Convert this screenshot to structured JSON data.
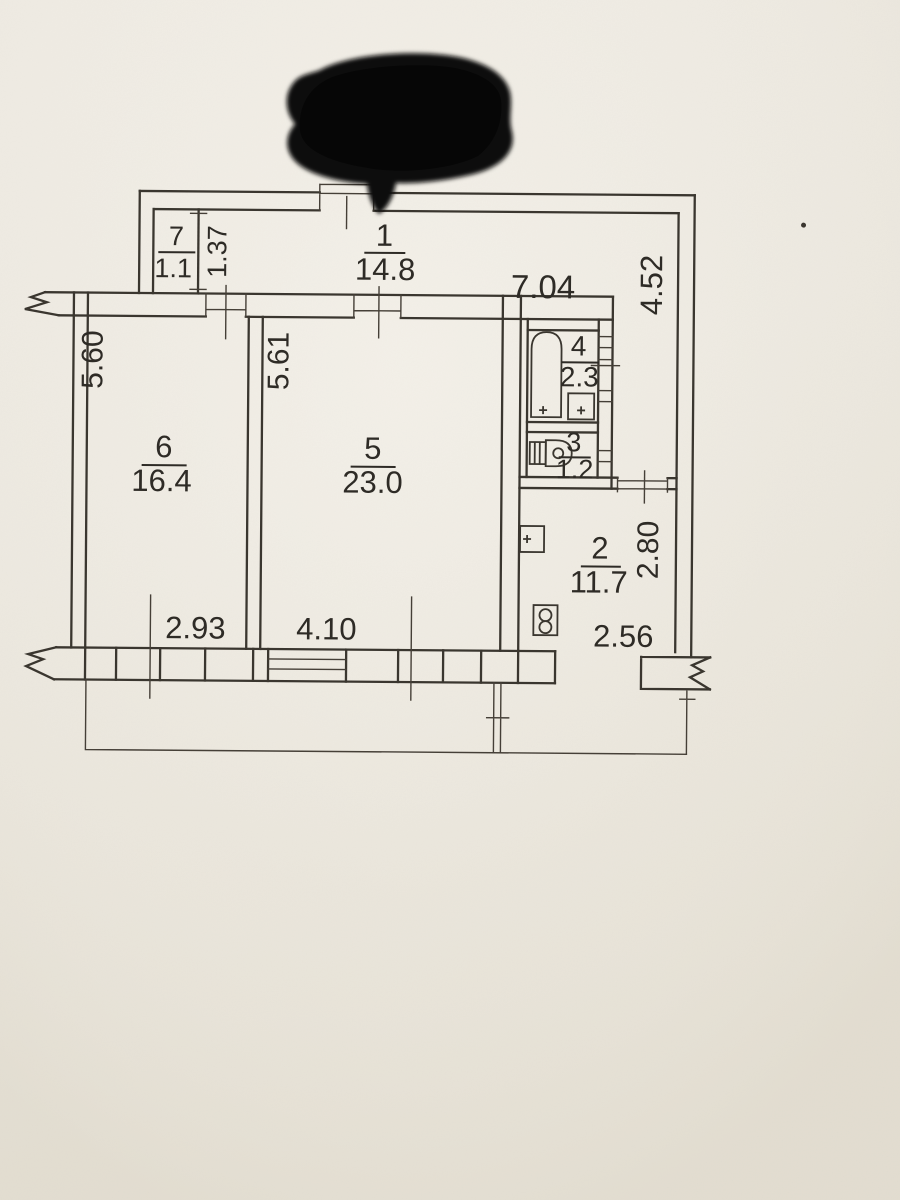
{
  "plan": {
    "title": "apartment-floor-plan-photo",
    "rooms": {
      "hall": {
        "number": "1",
        "area": "14.8"
      },
      "kitchen": {
        "number": "2",
        "area": "11.7"
      },
      "wc": {
        "number": "3",
        "area": "1.2"
      },
      "bath": {
        "number": "4",
        "area": "2.3"
      },
      "living": {
        "number": "5",
        "area": "23.0"
      },
      "bedroom": {
        "number": "6",
        "area": "16.4"
      },
      "closet": {
        "number": "7",
        "area": "1.1"
      }
    },
    "dims": {
      "hall_width": "7.04",
      "hall_depth": "4.52",
      "closet_depth": "1.37",
      "bedroom_length": "5.60",
      "living_length": "5.61",
      "bedroom_width": "2.93",
      "living_width": "4.10",
      "kitchen_depth": "2.80",
      "kitchen_width": "2.56"
    },
    "colors": {
      "paper": "#ece8df",
      "ink": "#3a362f",
      "redaction": "#0b0a09"
    }
  }
}
